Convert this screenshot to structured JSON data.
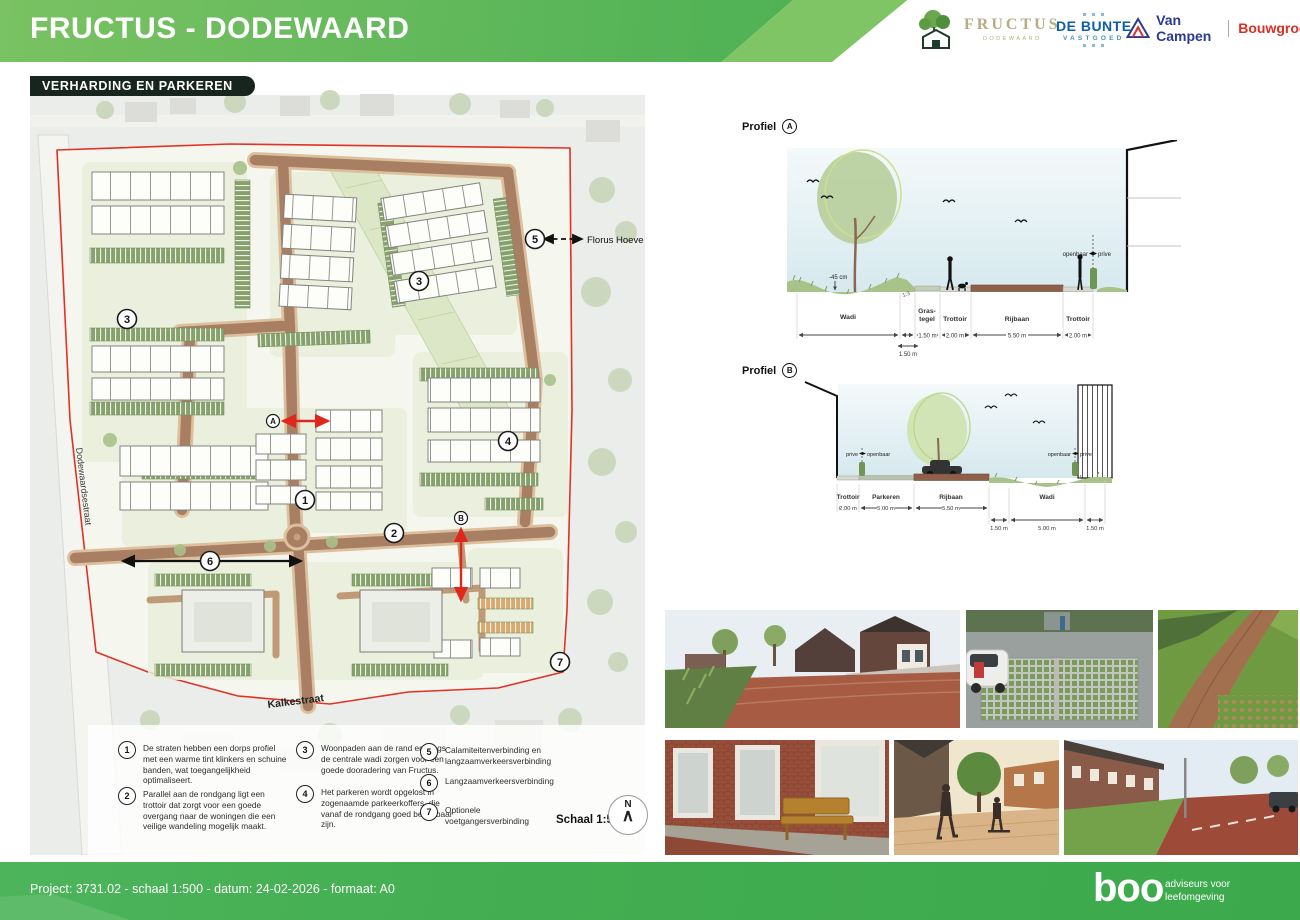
{
  "header": {
    "title": "FRUCTUS - DODEWAARD",
    "logos": {
      "fructus": {
        "name": "FRUCTUS",
        "sub": "DODEWAARD"
      },
      "debunte": {
        "name": "DE BUNTE",
        "sub": "VASTGOED"
      },
      "vancampen": {
        "name": "Van Campen",
        "sub": "Bouwgroep"
      }
    }
  },
  "map": {
    "badge": "VERHARDING EN PARKEREN",
    "street_vertical": "Dodewaardsestraat",
    "street_bottom": "Kalkestraat",
    "external_ref": "Florus Hoeve",
    "scale": "Schaal 1:500",
    "north": "N",
    "north_arrow": "∧",
    "callout_1": "1",
    "callout_2": "2",
    "callout_3": "3",
    "callout_4": "4",
    "callout_5": "5",
    "callout_6": "6",
    "callout_7": "7",
    "marker_a": "A",
    "marker_b": "B"
  },
  "legend": {
    "items": [
      {
        "num": "1",
        "text": "De straten hebben een dorps profiel met een warme tint klinkers en schuine banden, wat toegangelijkheid optimaliseert."
      },
      {
        "num": "2",
        "text": "Parallel aan de rondgang ligt een trottoir dat zorgt voor een goede overgang naar de woningen die een veilige wandeling mogelijk maakt."
      },
      {
        "num": "3",
        "text": "Woonpaden aan de rand en langs de centrale wadi zorgen voor een goede dooradering van Fructus."
      },
      {
        "num": "4",
        "text": "Het parkeren wordt opgelost in zogenaamde parkeerkoffers, die vanaf de rondgang goed bereikbaar zijn."
      },
      {
        "num": "5",
        "text": "Calamiteitenverbinding en langzaamverkeersverbinding"
      },
      {
        "num": "6",
        "text": "Langzaamverkeersverbinding"
      },
      {
        "num": "7",
        "text": "Optionele voetgangersverbinding"
      }
    ]
  },
  "profiles": {
    "a": {
      "title": "Profiel",
      "letter": "A",
      "labels": {
        "wadi": "Wadi",
        "gras1": "Gras-",
        "gras2": "tegel",
        "trottoir1": "Trottoir",
        "rijbaan": "Rijbaan",
        "trottoir2": "Trottoir"
      },
      "dims": {
        "gras": "1.50 m",
        "trottoir1": "2.00 m",
        "rijbaan": "5.50 m",
        "trottoir2": "2.00 m",
        "sub": "1.50 m"
      },
      "depth": "-45 cm",
      "slope": "1:3",
      "openbaar": "openbaar",
      "prive": "prive"
    },
    "b": {
      "title": "Profiel",
      "letter": "B",
      "labels": {
        "trottoir": "Trottoir",
        "parkeren": "Parkeren",
        "rijbaan": "Rijbaan",
        "wadi": "Wadi"
      },
      "dims": {
        "trottoir": "2.00 m",
        "parkeren": "5.00 m",
        "rijbaan": "5.50 m",
        "wadi_l": "1.50 m",
        "wadi_c": "5.00 m",
        "wadi_r": "1.50 m"
      },
      "left_prive": "prive",
      "left_openbaar": "openbaar",
      "right_openbaar": "openbaar",
      "right_prive": "prive"
    }
  },
  "footer": {
    "project": "Project: 3731.02 - schaal 1:500 - datum: 24-02-2026 - formaat: A0",
    "brand": "boo",
    "tagline1": "adviseurs voor",
    "tagline2": "leefomgeving"
  },
  "colors": {
    "header_green": "#4db054",
    "badge_dark": "#18251f",
    "boundary_red": "#e23125",
    "road_brown": "#a97f63",
    "parking_green": "#87a16d",
    "wadi_green": "#dce7c7"
  }
}
